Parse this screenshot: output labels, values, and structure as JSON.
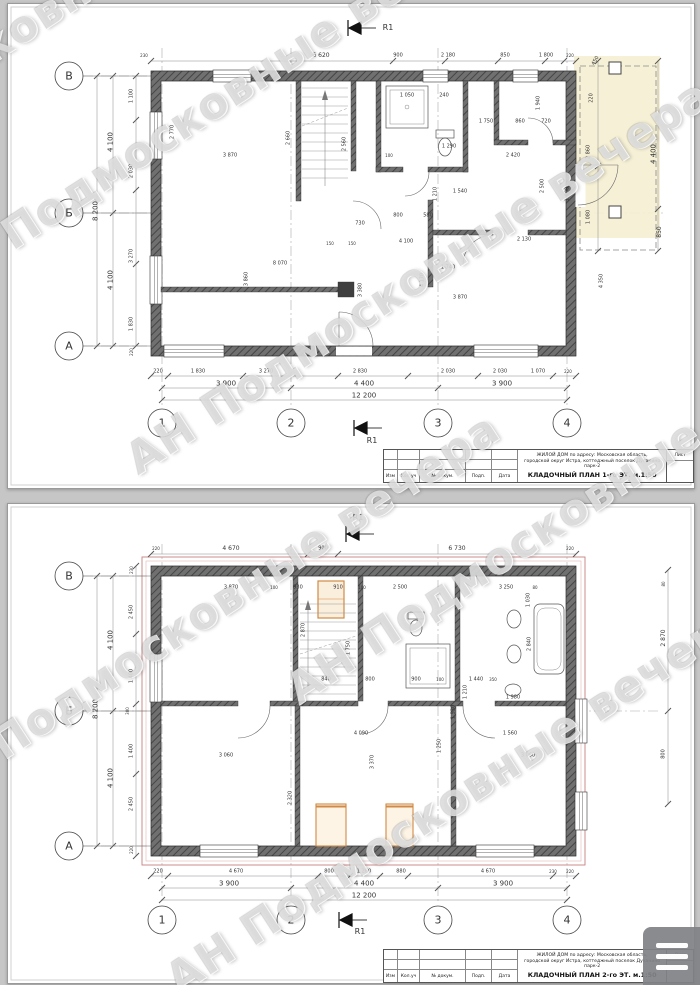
{
  "watermark": {
    "text": "АН Подмосковные вечера",
    "color": "#7a7a7a",
    "instances": [
      {
        "x": -260,
        "y": 185
      },
      {
        "x": -70,
        "y": 262
      },
      {
        "x": 130,
        "y": 438
      },
      {
        "x": -80,
        "y": 772
      },
      {
        "x": 290,
        "y": 668
      },
      {
        "x": 170,
        "y": 958
      }
    ]
  },
  "colors": {
    "wall": "#707070",
    "wall_dark": "#454545",
    "dim_text": "#333333",
    "accent_orange": "#d08a45",
    "roof_outline": "#c97f7f",
    "terrace_fill": "#f5efd2"
  },
  "menu": {
    "icon": "hamburger-icon"
  },
  "sheets": [
    {
      "id": "floor1",
      "titleblock": {
        "project_line1": "ЖИЛОЙ ДОМ по адресу: Московская область,",
        "project_line2": "городской округ Истра, коттеджный поселок Духанино парк-2",
        "plan_title": "КЛАДОЧНЫЙ ПЛАН 1-го ЭТ. м.1:50",
        "columns": [
          "Изм",
          "Кол.уч",
          "№ докум.",
          "Подп.",
          "Дата"
        ],
        "sheet_label": "Лист"
      },
      "labels": [
        {
          "t": "В",
          "x": 61,
          "y": 72,
          "s": 11,
          "n": "axis-label-v"
        },
        {
          "t": "Б",
          "x": 61,
          "y": 209,
          "s": 11,
          "n": "axis-label-b"
        },
        {
          "t": "А",
          "x": 61,
          "y": 342,
          "s": 11,
          "n": "axis-label-a"
        },
        {
          "t": "1",
          "x": 154,
          "y": 419,
          "s": 11,
          "n": "axis-label-1"
        },
        {
          "t": "2",
          "x": 283,
          "y": 419,
          "s": 11,
          "n": "axis-label-2"
        },
        {
          "t": "3",
          "x": 430,
          "y": 419,
          "s": 11,
          "n": "axis-label-3"
        },
        {
          "t": "4",
          "x": 559,
          "y": 419,
          "s": 11,
          "n": "axis-label-4"
        },
        {
          "t": "R1",
          "x": 380,
          "y": 24,
          "s": 8,
          "n": "section-marker-label"
        },
        {
          "t": "R1",
          "x": 364,
          "y": 437,
          "s": 8,
          "n": "section-marker-label"
        },
        {
          "t": "230",
          "x": 136,
          "y": 52,
          "s": 4
        },
        {
          "t": "6 620",
          "x": 313,
          "y": 52,
          "s": 6
        },
        {
          "t": "900",
          "x": 390,
          "y": 52,
          "s": 5
        },
        {
          "t": "2 180",
          "x": 440,
          "y": 52,
          "s": 5
        },
        {
          "t": "850",
          "x": 497,
          "y": 52,
          "s": 5
        },
        {
          "t": "1 800",
          "x": 538,
          "y": 52,
          "s": 5
        },
        {
          "t": "220",
          "x": 562,
          "y": 52,
          "s": 4
        },
        {
          "t": "450",
          "x": 588,
          "y": 57,
          "r": -60,
          "s": 5
        },
        {
          "t": "220",
          "x": 584,
          "y": 94,
          "r": -90,
          "s": 5
        },
        {
          "t": "2 860",
          "x": 581,
          "y": 148,
          "r": -90,
          "s": 5
        },
        {
          "t": "1 080",
          "x": 581,
          "y": 213,
          "r": -90,
          "s": 5
        },
        {
          "t": "4 400",
          "x": 646,
          "y": 150,
          "r": -90,
          "s": 7
        },
        {
          "t": "850",
          "x": 652,
          "y": 228,
          "r": -90,
          "s": 6
        },
        {
          "t": "4 100",
          "x": 103,
          "y": 138,
          "r": -90,
          "s": 7
        },
        {
          "t": "8 200",
          "x": 88,
          "y": 207,
          "r": -90,
          "s": 7
        },
        {
          "t": "4 100",
          "x": 103,
          "y": 276,
          "r": -90,
          "s": 7
        },
        {
          "t": "1 100",
          "x": 124,
          "y": 92,
          "r": -90,
          "s": 5
        },
        {
          "t": "2 030",
          "x": 124,
          "y": 167,
          "r": -90,
          "s": 5
        },
        {
          "t": "3 270",
          "x": 124,
          "y": 252,
          "r": -90,
          "s": 5
        },
        {
          "t": "1 830",
          "x": 124,
          "y": 320,
          "r": -90,
          "s": 5
        },
        {
          "t": "220",
          "x": 124,
          "y": 348,
          "r": -90,
          "s": 4
        },
        {
          "t": "220",
          "x": 150,
          "y": 368,
          "s": 5
        },
        {
          "t": "1 830",
          "x": 190,
          "y": 368,
          "s": 5
        },
        {
          "t": "3 270",
          "x": 258,
          "y": 368,
          "s": 5
        },
        {
          "t": "2 830",
          "x": 352,
          "y": 368,
          "s": 5
        },
        {
          "t": "2 030",
          "x": 440,
          "y": 368,
          "s": 5
        },
        {
          "t": "2 030",
          "x": 492,
          "y": 368,
          "s": 5
        },
        {
          "t": "1 070",
          "x": 530,
          "y": 368,
          "s": 5
        },
        {
          "t": "220",
          "x": 560,
          "y": 368,
          "s": 4
        },
        {
          "t": "3 900",
          "x": 218,
          "y": 380,
          "s": 7
        },
        {
          "t": "4 400",
          "x": 356,
          "y": 380,
          "s": 7
        },
        {
          "t": "3 900",
          "x": 494,
          "y": 380,
          "s": 7
        },
        {
          "t": "12 200",
          "x": 356,
          "y": 392,
          "s": 7
        },
        {
          "t": "2 770",
          "x": 165,
          "y": 128,
          "r": -90,
          "s": 5
        },
        {
          "t": "3 870",
          "x": 222,
          "y": 152,
          "s": 5
        },
        {
          "t": "2 660",
          "x": 281,
          "y": 134,
          "r": -90,
          "s": 5
        },
        {
          "t": "2 560",
          "x": 337,
          "y": 140,
          "r": -90,
          "s": 5
        },
        {
          "t": "1 050",
          "x": 399,
          "y": 92,
          "s": 5
        },
        {
          "t": "240",
          "x": 436,
          "y": 92,
          "s": 5
        },
        {
          "t": "1 940",
          "x": 531,
          "y": 99,
          "r": -90,
          "s": 5
        },
        {
          "t": "1 290",
          "x": 441,
          "y": 143,
          "s": 5
        },
        {
          "t": "1 750",
          "x": 478,
          "y": 118,
          "s": 5
        },
        {
          "t": "860",
          "x": 512,
          "y": 118,
          "s": 5
        },
        {
          "t": "720",
          "x": 538,
          "y": 118,
          "s": 5
        },
        {
          "t": "100",
          "x": 381,
          "y": 152,
          "s": 4
        },
        {
          "t": "2 420",
          "x": 505,
          "y": 152,
          "s": 5
        },
        {
          "t": "1 540",
          "x": 452,
          "y": 188,
          "s": 5
        },
        {
          "t": "1 210",
          "x": 428,
          "y": 190,
          "r": -90,
          "s": 5
        },
        {
          "t": "2 500",
          "x": 535,
          "y": 182,
          "r": -90,
          "s": 5
        },
        {
          "t": "1 000",
          "x": 560,
          "y": 190,
          "r": -90,
          "s": 5
        },
        {
          "t": "800",
          "x": 390,
          "y": 212,
          "s": 5
        },
        {
          "t": "730",
          "x": 352,
          "y": 220,
          "s": 5
        },
        {
          "t": "580",
          "x": 420,
          "y": 212,
          "s": 5
        },
        {
          "t": "150",
          "x": 322,
          "y": 240,
          "s": 4
        },
        {
          "t": "150",
          "x": 344,
          "y": 240,
          "s": 4
        },
        {
          "t": "4 100",
          "x": 398,
          "y": 238,
          "s": 5
        },
        {
          "t": "2 130",
          "x": 516,
          "y": 236,
          "s": 5
        },
        {
          "t": "1 740",
          "x": 440,
          "y": 264,
          "s": 5
        },
        {
          "t": "8 070",
          "x": 272,
          "y": 260,
          "s": 5
        },
        {
          "t": "4 170",
          "x": 415,
          "y": 276,
          "r": -90,
          "s": 5
        },
        {
          "t": "3 860",
          "x": 239,
          "y": 275,
          "r": -90,
          "s": 5
        },
        {
          "t": "3 380",
          "x": 353,
          "y": 286,
          "r": -90,
          "s": 5
        },
        {
          "t": "3 870",
          "x": 452,
          "y": 294,
          "s": 5
        },
        {
          "t": "4 350",
          "x": 594,
          "y": 277,
          "r": -90,
          "s": 5
        }
      ]
    },
    {
      "id": "floor2",
      "titleblock": {
        "project_line1": "ЖИЛОЙ ДОМ по адресу: Московская область,",
        "project_line2": "городской округ Истра, коттеджный поселок Духанино парк-2",
        "plan_title": "КЛАДОЧНЫЙ ПЛАН 2-го ЭТ. м.1:50",
        "columns": [
          "Изм",
          "Кол.уч",
          "№ докум.",
          "Подп.",
          "Дата"
        ],
        "sheet_label": "Лист"
      },
      "labels": [
        {
          "t": "В",
          "x": 61,
          "y": 72,
          "s": 11,
          "n": "axis-label-v"
        },
        {
          "t": "Б",
          "x": 61,
          "y": 207,
          "s": 11,
          "n": "axis-label-b"
        },
        {
          "t": "А",
          "x": 61,
          "y": 342,
          "s": 11,
          "n": "axis-label-a"
        },
        {
          "t": "1",
          "x": 154,
          "y": 416,
          "s": 11,
          "n": "axis-label-1"
        },
        {
          "t": "2",
          "x": 283,
          "y": 416,
          "s": 11,
          "n": "axis-label-2"
        },
        {
          "t": "3",
          "x": 430,
          "y": 416,
          "s": 11,
          "n": "axis-label-3"
        },
        {
          "t": "4",
          "x": 559,
          "y": 416,
          "s": 11,
          "n": "axis-label-4"
        },
        {
          "t": "R1",
          "x": 350,
          "y": 14,
          "s": 8,
          "n": "section-marker-label"
        },
        {
          "t": "R1",
          "x": 352,
          "y": 428,
          "s": 8,
          "n": "section-marker-label"
        },
        {
          "t": "220",
          "x": 148,
          "y": 45,
          "s": 4
        },
        {
          "t": "4 670",
          "x": 223,
          "y": 45,
          "s": 6
        },
        {
          "t": "900",
          "x": 315,
          "y": 45,
          "s": 5
        },
        {
          "t": "6 730",
          "x": 449,
          "y": 45,
          "s": 6
        },
        {
          "t": "220",
          "x": 562,
          "y": 45,
          "s": 4
        },
        {
          "t": "4 100",
          "x": 103,
          "y": 136,
          "r": -90,
          "s": 7
        },
        {
          "t": "8 200",
          "x": 88,
          "y": 205,
          "r": -90,
          "s": 7
        },
        {
          "t": "4 100",
          "x": 103,
          "y": 274,
          "r": -90,
          "s": 7
        },
        {
          "t": "230",
          "x": 124,
          "y": 66,
          "r": -90,
          "s": 4
        },
        {
          "t": "2 450",
          "x": 124,
          "y": 108,
          "r": -90,
          "s": 5
        },
        {
          "t": "1 400",
          "x": 124,
          "y": 172,
          "r": -90,
          "s": 5
        },
        {
          "t": "300",
          "x": 120,
          "y": 207,
          "r": -90,
          "s": 4
        },
        {
          "t": "1 400",
          "x": 124,
          "y": 247,
          "r": -90,
          "s": 5
        },
        {
          "t": "2 450",
          "x": 124,
          "y": 300,
          "r": -90,
          "s": 5
        },
        {
          "t": "220",
          "x": 124,
          "y": 346,
          "r": -90,
          "s": 4
        },
        {
          "t": "80",
          "x": 656,
          "y": 80,
          "r": -90,
          "s": 4
        },
        {
          "t": "2 870",
          "x": 656,
          "y": 134,
          "r": -90,
          "s": 6
        },
        {
          "t": "800",
          "x": 656,
          "y": 250,
          "r": -90,
          "s": 5
        },
        {
          "t": "220",
          "x": 150,
          "y": 368,
          "s": 5
        },
        {
          "t": "4 670",
          "x": 228,
          "y": 368,
          "s": 5
        },
        {
          "t": "800",
          "x": 321,
          "y": 368,
          "s": 5
        },
        {
          "t": "1 260",
          "x": 356,
          "y": 368,
          "s": 5
        },
        {
          "t": "880",
          "x": 393,
          "y": 368,
          "s": 5
        },
        {
          "t": "4 670",
          "x": 480,
          "y": 368,
          "s": 5
        },
        {
          "t": "230",
          "x": 545,
          "y": 368,
          "s": 4
        },
        {
          "t": "220",
          "x": 562,
          "y": 368,
          "s": 4
        },
        {
          "t": "3 900",
          "x": 221,
          "y": 380,
          "s": 7
        },
        {
          "t": "4 400",
          "x": 356,
          "y": 380,
          "s": 7
        },
        {
          "t": "3 900",
          "x": 495,
          "y": 380,
          "s": 7
        },
        {
          "t": "12 200",
          "x": 356,
          "y": 392,
          "s": 7
        },
        {
          "t": "3 870",
          "x": 223,
          "y": 84,
          "s": 5
        },
        {
          "t": "100",
          "x": 266,
          "y": 84,
          "s": 4
        },
        {
          "t": "930",
          "x": 290,
          "y": 84,
          "s": 5
        },
        {
          "t": "910",
          "x": 330,
          "y": 84,
          "s": 5
        },
        {
          "t": "100",
          "x": 354,
          "y": 84,
          "s": 4
        },
        {
          "t": "2 500",
          "x": 392,
          "y": 84,
          "s": 5
        },
        {
          "t": "3 250",
          "x": 498,
          "y": 84,
          "s": 5
        },
        {
          "t": "80",
          "x": 527,
          "y": 84,
          "s": 4
        },
        {
          "t": "1 030",
          "x": 521,
          "y": 96,
          "r": -90,
          "s": 5
        },
        {
          "t": "2 870",
          "x": 296,
          "y": 126,
          "r": -90,
          "s": 5
        },
        {
          "t": "1 750",
          "x": 341,
          "y": 144,
          "r": -90,
          "s": 5
        },
        {
          "t": "2 840",
          "x": 522,
          "y": 140,
          "r": -90,
          "s": 5
        },
        {
          "t": "1 980",
          "x": 505,
          "y": 194,
          "s": 5
        },
        {
          "t": "1 440",
          "x": 468,
          "y": 176,
          "s": 5
        },
        {
          "t": "1 210",
          "x": 458,
          "y": 188,
          "r": -90,
          "s": 5
        },
        {
          "t": "1 530",
          "x": 446,
          "y": 208,
          "r": -90,
          "s": 5
        },
        {
          "t": "900",
          "x": 408,
          "y": 176,
          "s": 5
        },
        {
          "t": "800",
          "x": 362,
          "y": 176,
          "s": 5
        },
        {
          "t": "840",
          "x": 318,
          "y": 176,
          "s": 5
        },
        {
          "t": "350",
          "x": 485,
          "y": 176,
          "s": 4
        },
        {
          "t": "100",
          "x": 432,
          "y": 176,
          "s": 4
        },
        {
          "t": "4 090",
          "x": 353,
          "y": 230,
          "s": 5
        },
        {
          "t": "3 370",
          "x": 365,
          "y": 258,
          "r": -90,
          "s": 5
        },
        {
          "t": "1 250",
          "x": 432,
          "y": 242,
          "r": -90,
          "s": 5
        },
        {
          "t": "1 560",
          "x": 502,
          "y": 230,
          "s": 5
        },
        {
          "t": "3 060",
          "x": 218,
          "y": 252,
          "s": 5
        },
        {
          "t": "3 060",
          "x": 520,
          "y": 252,
          "s": 5
        },
        {
          "t": "2 320",
          "x": 283,
          "y": 294,
          "r": -90,
          "s": 5
        }
      ]
    }
  ]
}
